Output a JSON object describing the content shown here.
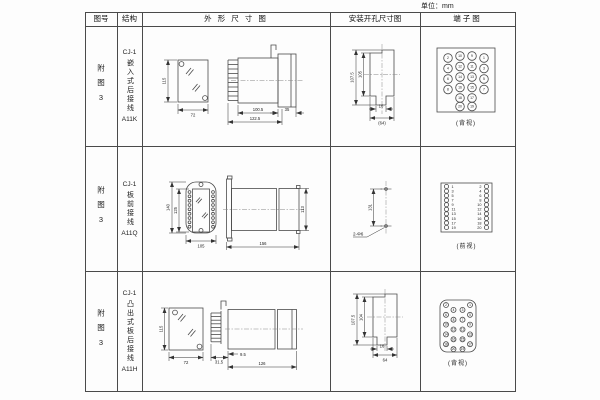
{
  "unit_label": "单位：mm",
  "header": {
    "fig_no": "图号",
    "structure": "结构",
    "outline": "外 形 尺 寸 图",
    "mounting": "安装开孔尺寸图",
    "terminal": "端子图"
  },
  "rows": [
    {
      "fig_no": "附图3",
      "model": "CJ-1",
      "mount_type": "嵌入式后接线",
      "code": "A11K",
      "outline": {
        "h": "115",
        "w": "72",
        "d1": "100.5",
        "d2": "122.5",
        "d3": "35"
      },
      "mounting": {
        "h1": "107.5",
        "h2": "105",
        "w1": "16",
        "w2": "(64)"
      },
      "terminal": {
        "label": "(背视)",
        "nums": [
          "2",
          "10",
          "9",
          "1",
          "4",
          "12",
          "11",
          "3",
          "6",
          "14",
          "13",
          "5",
          "8",
          "16",
          "15",
          "7",
          "18",
          "17",
          "20",
          "19"
        ]
      }
    },
    {
      "fig_no": "附图3",
      "model": "CJ-1",
      "mount_type": "板前接线",
      "code": "A11Q",
      "outline": {
        "h1": "140",
        "h2": "125",
        "w": "105",
        "d": "156",
        "sh": "113"
      },
      "mounting": {
        "spacing": "131",
        "holes": "2-Φ6"
      },
      "terminal": {
        "label": "(前视)",
        "left": [
          "1",
          "3",
          "5",
          "7",
          "9",
          "11",
          "13",
          "15",
          "17",
          "19"
        ],
        "right": [
          "2",
          "4",
          "6",
          "8",
          "10",
          "12",
          "14",
          "16",
          "18",
          "20"
        ]
      }
    },
    {
      "fig_no": "附图3",
      "model": "CJ-1",
      "mount_type": "凸出式板后接线",
      "code": "A11H",
      "outline": {
        "h": "115",
        "w": "72",
        "d1": "31.5",
        "d2": "9.5",
        "d3": "126"
      },
      "mounting": {
        "h1": "107.5",
        "h2": "104",
        "w1": "16",
        "w2": "64"
      },
      "terminal": {
        "label": "(背视)",
        "lo": [
          "2",
          "6",
          "10",
          "14",
          "18"
        ],
        "li": [
          "4",
          "8",
          "12",
          "16",
          "20"
        ],
        "ri": [
          "3",
          "7",
          "11",
          "15",
          "19"
        ],
        "ro": [
          "1",
          "5",
          "9",
          "13",
          "17"
        ]
      }
    }
  ]
}
